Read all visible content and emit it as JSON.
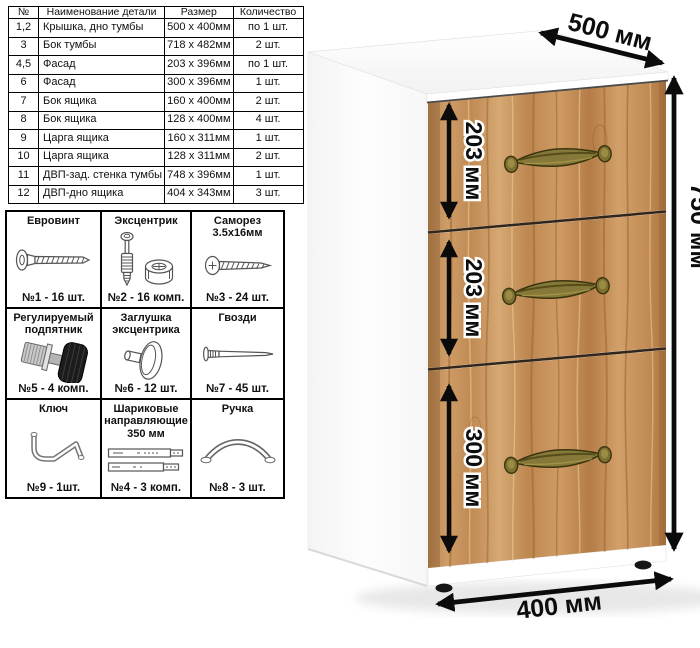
{
  "parts_table": {
    "headers": [
      "№",
      "Наименование детали",
      "Размер",
      "Количество"
    ],
    "rows": [
      {
        "num": "1,2",
        "name": "Крышка, дно тумбы",
        "size": "500 х 400мм",
        "qty": "по 1 шт."
      },
      {
        "num": "3",
        "name": "Бок тумбы",
        "size": "718 х 482мм",
        "qty": "2 шт."
      },
      {
        "num": "4,5",
        "name": "Фасад",
        "size": "203 х 396мм",
        "qty": "по 1 шт."
      },
      {
        "num": "6",
        "name": "Фасад",
        "size": "300 х 396мм",
        "qty": "1 шт."
      },
      {
        "num": "7",
        "name": "Бок ящика",
        "size": "160 х 400мм",
        "qty": "2 шт."
      },
      {
        "num": "8",
        "name": "Бок ящика",
        "size": "128 х 400мм",
        "qty": "4 шт."
      },
      {
        "num": "9",
        "name": "Царга ящика",
        "size": "160 х 311мм",
        "qty": "1 шт."
      },
      {
        "num": "10",
        "name": "Царга ящика",
        "size": "128 х 311мм",
        "qty": "2 шт."
      },
      {
        "num": "11",
        "name": "ДВП-зад. стенка тумбы",
        "size": "748 х 396мм",
        "qty": "1 шт."
      },
      {
        "num": "12",
        "name": "ДВП-дно ящика",
        "size": "404 х 343мм",
        "qty": "3 шт."
      }
    ]
  },
  "hardware": {
    "cells": [
      {
        "title": "Евровинт",
        "icon": "euro-screw-icon",
        "qty": "№1 - 16 шт."
      },
      {
        "title": "Эксцентрик",
        "icon": "eccentric-cam-icon",
        "qty": "№2 - 16 комп."
      },
      {
        "title": "Саморез\n3.5х16мм",
        "icon": "self-tapping-screw-icon",
        "qty": "№3 - 24 шт."
      },
      {
        "title": "Регулируемый\nподпятник",
        "icon": "adjustable-foot-icon",
        "qty": "№5 - 4 комп."
      },
      {
        "title": "Заглушка\nэксцентрика",
        "icon": "cam-cover-icon",
        "qty": "№6 - 12 шт."
      },
      {
        "title": "Гвозди",
        "icon": "nail-icon",
        "qty": "№7 - 45 шт."
      },
      {
        "title": "Ключ",
        "icon": "hex-key-icon",
        "qty": "№9 - 1шт."
      },
      {
        "title": "Шариковые\nнаправляющие\n350 мм",
        "icon": "ball-slides-icon",
        "qty": "№4 - 3 комп."
      },
      {
        "title": "Ручка",
        "icon": "handle-icon",
        "qty": "№8 - 3 шт."
      }
    ]
  },
  "dimensions": {
    "width": "500 мм",
    "height": "750 мм",
    "depth": "400 мм",
    "drawers": [
      "203 мм",
      "203 мм",
      "300 мм"
    ]
  },
  "colors": {
    "wood": "#c89058",
    "wood_dark": "#a87444",
    "wood_light": "#e0b488",
    "handle_brass": "#8a7c33",
    "arrow": "#0b0b0b",
    "body_white": "#fbfbfb"
  }
}
